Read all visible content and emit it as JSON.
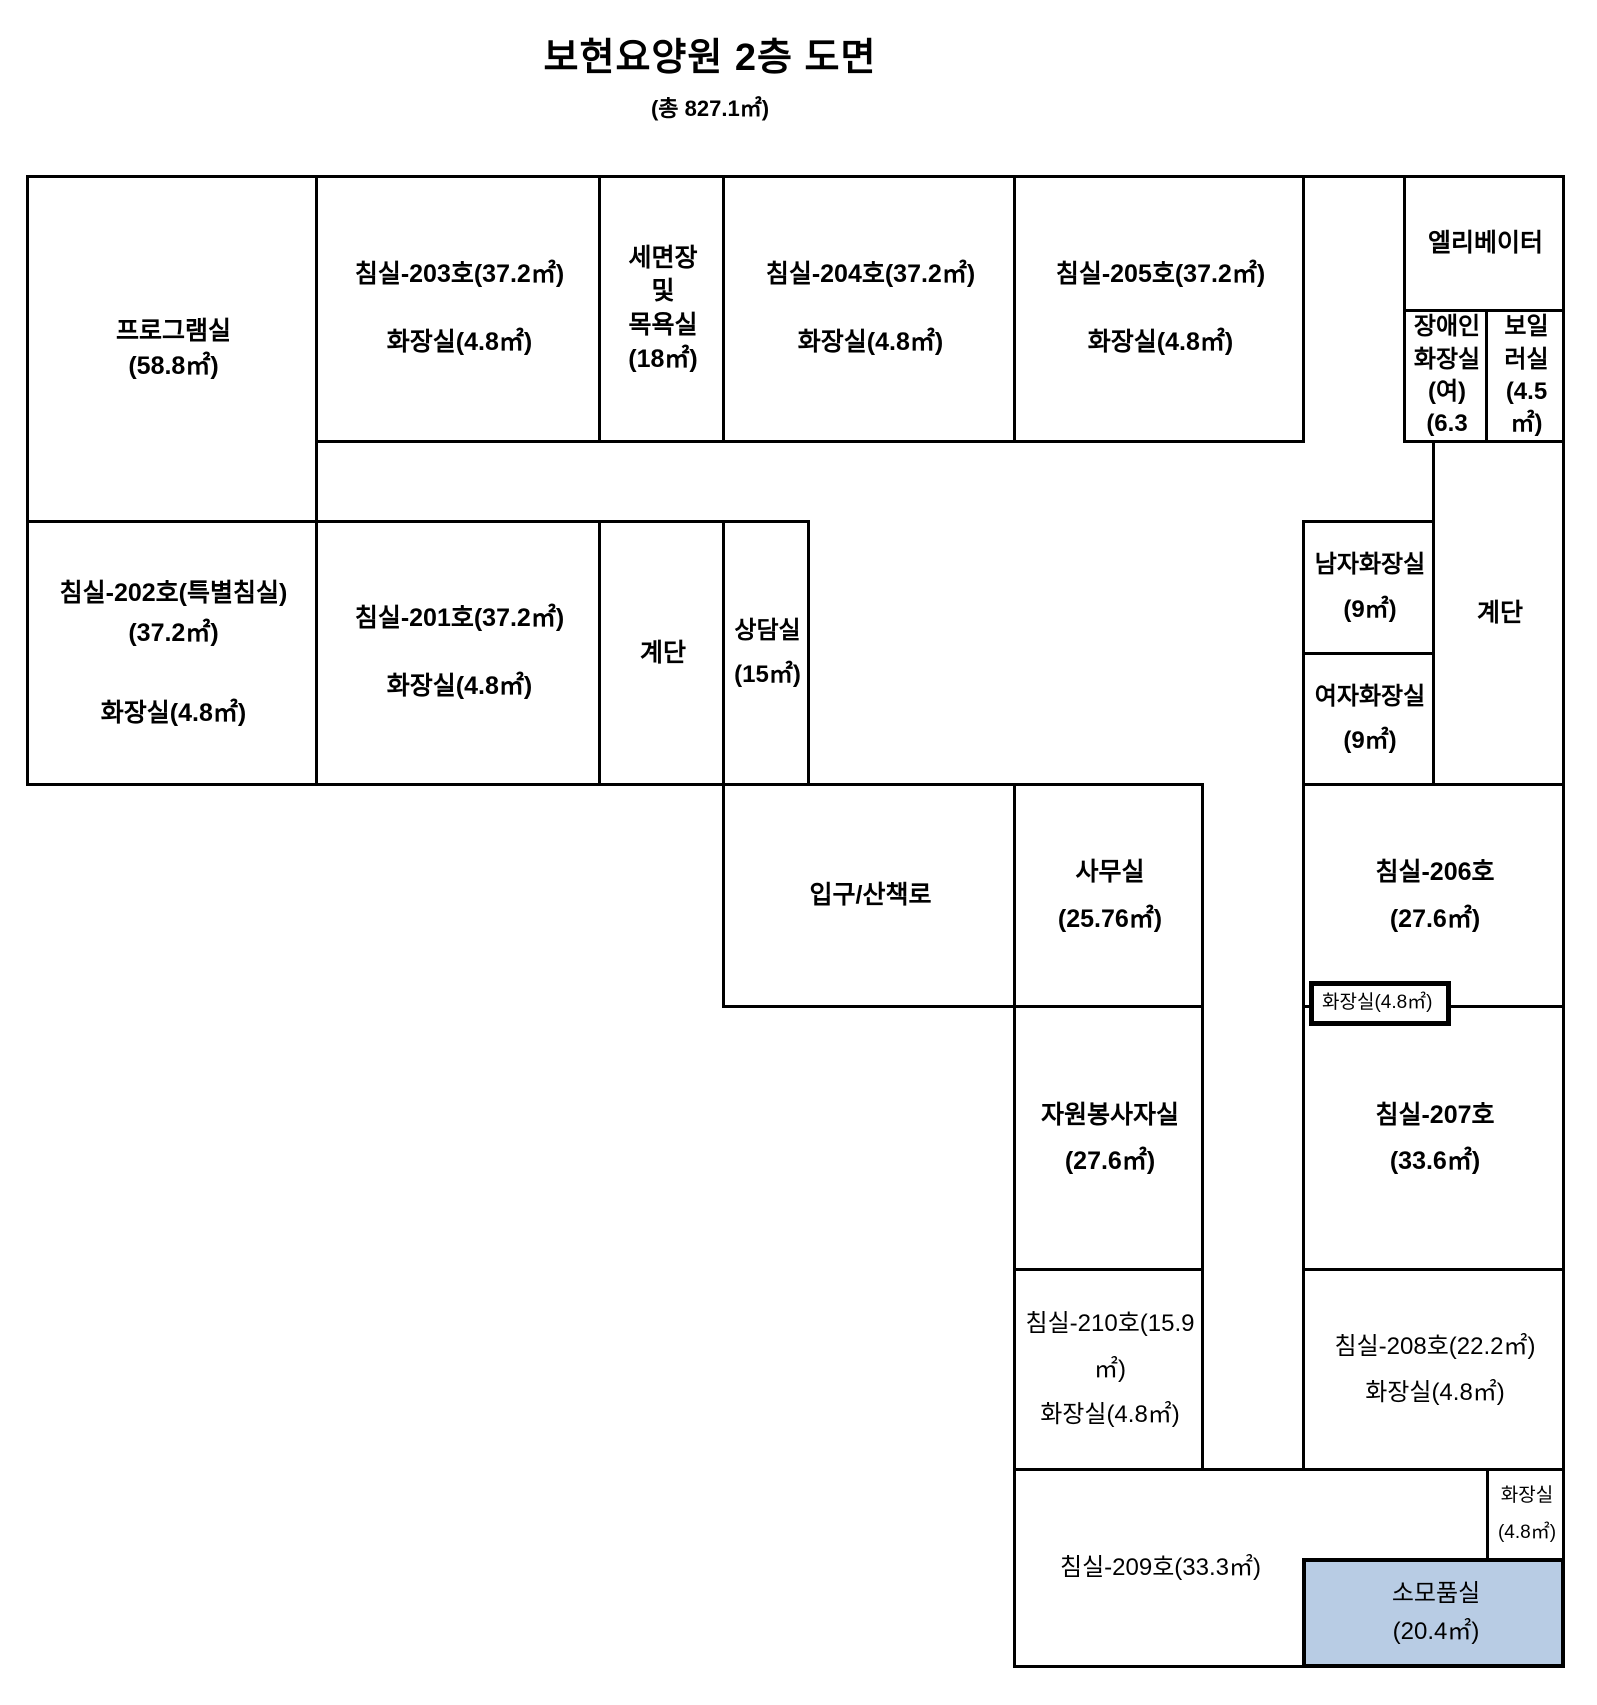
{
  "title": {
    "text": "보현요양원 2층 도면",
    "subtitle": "(총 827.1㎡)"
  },
  "canvas": {
    "width": 1597,
    "height": 1705,
    "line_color": "#000000",
    "background": "#ffffff",
    "highlight_fill": "#b8cce4"
  },
  "rooms": [
    {
      "id": "program-room",
      "lines": [
        "프로그램실",
        "(58.8㎡)"
      ],
      "x1": 26,
      "y1": 175,
      "x2": 315,
      "y2": 520,
      "bold": true,
      "font": 25,
      "lh": 1.4
    },
    {
      "id": "bedroom-203",
      "lines": [
        "침실-203호(37.2㎡)",
        "",
        "화장실(4.8㎡)"
      ],
      "x1": 315,
      "y1": 175,
      "x2": 598,
      "y2": 440,
      "bold": true,
      "font": 25,
      "lh": 1.35
    },
    {
      "id": "washroom-bathroom",
      "lines": [
        "세면장",
        "및",
        "목욕실",
        "(18㎡)"
      ],
      "x1": 598,
      "y1": 175,
      "x2": 722,
      "y2": 440,
      "bold": true,
      "font": 25,
      "lh": 1.35
    },
    {
      "id": "bedroom-204",
      "lines": [
        "침실-204호(37.2㎡)",
        "",
        "화장실(4.8㎡)"
      ],
      "x1": 722,
      "y1": 175,
      "x2": 1013,
      "y2": 440,
      "bold": true,
      "font": 25,
      "lh": 1.35
    },
    {
      "id": "bedroom-205",
      "lines": [
        "침실-205호(37.2㎡)",
        "",
        "화장실(4.8㎡)"
      ],
      "x1": 1013,
      "y1": 175,
      "x2": 1302,
      "y2": 440,
      "bold": true,
      "font": 25,
      "lh": 1.35
    },
    {
      "id": "elevator",
      "lines": [
        "엘리베이터"
      ],
      "x1": 1403,
      "y1": 175,
      "x2": 1562,
      "y2": 309,
      "bold": true,
      "font": 25,
      "lh": 1.4
    },
    {
      "id": "disabled-toilet-female",
      "lines": [
        "장애인",
        "화장실",
        "(여)",
        "(6.3"
      ],
      "x1": 1403,
      "y1": 309,
      "x2": 1485,
      "y2": 440,
      "bold": true,
      "font": 24,
      "lh": 1.35
    },
    {
      "id": "boiler-room",
      "lines": [
        "보일",
        "러실",
        "(4.5",
        "㎡)"
      ],
      "x1": 1485,
      "y1": 309,
      "x2": 1562,
      "y2": 440,
      "bold": true,
      "font": 24,
      "lh": 1.35
    },
    {
      "id": "bedroom-202-special",
      "lines": [
        "침실-202호(특별침실)",
        "(37.2㎡)",
        "",
        "화장실(4.8㎡)"
      ],
      "x1": 26,
      "y1": 520,
      "x2": 315,
      "y2": 783,
      "bold": true,
      "font": 25,
      "lh": 1.6
    },
    {
      "id": "bedroom-201",
      "lines": [
        "침실-201호(37.2㎡)",
        "",
        "화장실(4.8㎡)"
      ],
      "x1": 315,
      "y1": 520,
      "x2": 598,
      "y2": 783,
      "bold": true,
      "font": 25,
      "lh": 1.35
    },
    {
      "id": "stairs-left",
      "lines": [
        "계단"
      ],
      "x1": 598,
      "y1": 520,
      "x2": 722,
      "y2": 783,
      "bold": true,
      "font": 25,
      "lh": 1.4
    },
    {
      "id": "counseling-room",
      "lines": [
        "상담실",
        "(15㎡)"
      ],
      "x1": 722,
      "y1": 520,
      "x2": 807,
      "y2": 783,
      "bold": true,
      "font": 24,
      "lh": 1.85
    },
    {
      "id": "mens-toilet",
      "lines": [
        "남자화장실",
        "(9㎡)"
      ],
      "x1": 1302,
      "y1": 520,
      "x2": 1432,
      "y2": 652,
      "bold": true,
      "font": 24,
      "lh": 1.85
    },
    {
      "id": "womens-toilet",
      "lines": [
        "여자화장실",
        "(9㎡)"
      ],
      "x1": 1302,
      "y1": 652,
      "x2": 1432,
      "y2": 783,
      "bold": true,
      "font": 24,
      "lh": 1.85
    },
    {
      "id": "stairs-right",
      "lines": [
        "계단"
      ],
      "x1": 1432,
      "y1": 440,
      "x2": 1562,
      "y2": 783,
      "bold": true,
      "font": 25,
      "lh": 1.4
    },
    {
      "id": "entrance-walkway",
      "lines": [
        "입구/산책로"
      ],
      "x1": 722,
      "y1": 783,
      "x2": 1013,
      "y2": 1005,
      "bold": true,
      "font": 25,
      "lh": 1.4
    },
    {
      "id": "office",
      "lines": [
        "사무실",
        "(25.76㎡)"
      ],
      "x1": 1013,
      "y1": 783,
      "x2": 1201,
      "y2": 1005,
      "bold": true,
      "font": 25,
      "lh": 1.85
    },
    {
      "id": "bedroom-206",
      "lines": [
        "침실-206호",
        "(27.6㎡)"
      ],
      "x1": 1302,
      "y1": 783,
      "x2": 1562,
      "y2": 1005,
      "bold": true,
      "font": 25,
      "lh": 1.85
    },
    {
      "id": "volunteer-room",
      "lines": [
        "자원봉사자실",
        "(27.6㎡)"
      ],
      "x1": 1013,
      "y1": 1005,
      "x2": 1201,
      "y2": 1268,
      "bold": true,
      "font": 25,
      "lh": 1.85
    },
    {
      "id": "bedroom-207",
      "lines": [
        "침실-207호",
        "(33.6㎡)"
      ],
      "x1": 1302,
      "y1": 1005,
      "x2": 1562,
      "y2": 1268,
      "bold": true,
      "font": 25,
      "lh": 1.85
    },
    {
      "id": "bedroom-210",
      "lines": [
        "침실-210호(15.9",
        "㎡)",
        "화장실(4.8㎡)"
      ],
      "x1": 1013,
      "y1": 1268,
      "x2": 1201,
      "y2": 1468,
      "bold": false,
      "font": 24,
      "lh": 1.9
    },
    {
      "id": "bedroom-208",
      "lines": [
        "침실-208호(22.2㎡)",
        "화장실(4.8㎡)"
      ],
      "x1": 1302,
      "y1": 1268,
      "x2": 1562,
      "y2": 1468,
      "bold": false,
      "font": 24,
      "lh": 1.9
    },
    {
      "id": "bedroom-209",
      "lines": [
        "침실-209호(33.3㎡)"
      ],
      "x1": 1013,
      "y1": 1468,
      "x2": 1562,
      "y2": 1665,
      "bold": false,
      "font": 24,
      "lh": 1.4,
      "label_x2": 1302
    },
    {
      "id": "toilet-corner",
      "lines": [
        "화장실",
        "(4.8㎡)"
      ],
      "x1": 1486,
      "y1": 1468,
      "x2": 1562,
      "y2": 1558,
      "bold": false,
      "font": 19,
      "lh": 1.9
    },
    {
      "id": "supply-room",
      "lines": [
        "소모품실",
        "(20.4㎡)"
      ],
      "x1": 1302,
      "y1": 1558,
      "x2": 1562,
      "y2": 1665,
      "bold": false,
      "font": 24,
      "lh": 1.6,
      "fill": "#b8cce4",
      "bw": 4
    },
    {
      "id": "toilet-mid",
      "lines": [
        "화장실(4.8㎡)"
      ],
      "x1": 1309,
      "y1": 981,
      "x2": 1448,
      "y2": 1023,
      "bold": false,
      "font": 19,
      "lh": 1.2,
      "bw": 5,
      "fill": "#ffffff",
      "z": 5,
      "align": "left"
    }
  ],
  "segments": [
    {
      "id": "top-wall-gap",
      "x": 1302,
      "y": 175,
      "w": 104,
      "h": 3
    }
  ]
}
